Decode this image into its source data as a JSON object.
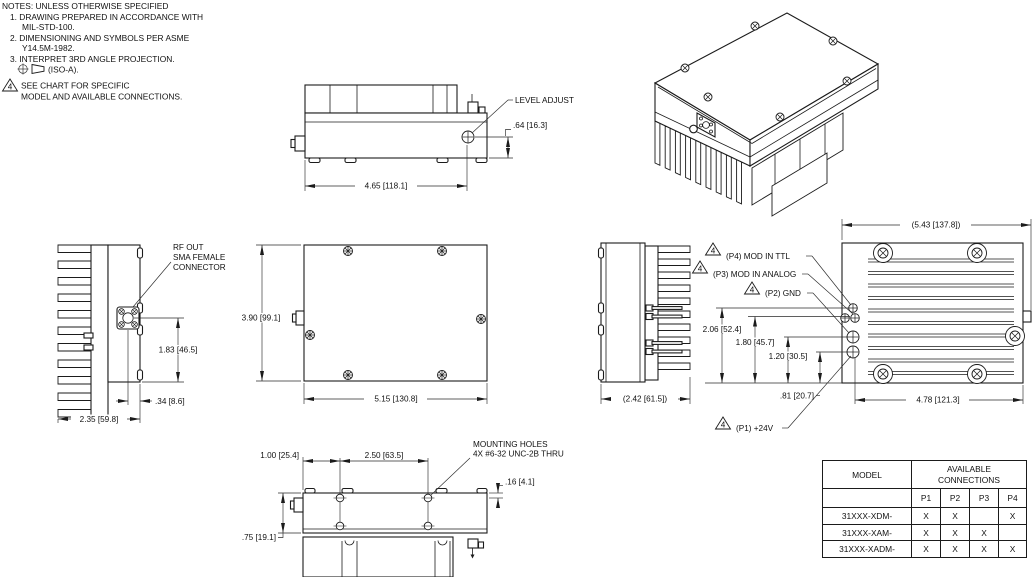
{
  "flag": "4",
  "notes": {
    "title": "NOTES:  UNLESS  OTHERWISE  SPECIFIED",
    "n1a": "1.  DRAWING  PREPARED  IN  ACCORDANCE  WITH",
    "n1b": "MIL-STD-100.",
    "n2a": "2.  DIMENSIONING  AND  SYMBOLS  PER  ASME",
    "n2b": "Y14.5M-1982.",
    "n3a": "3.  INTERPRET  3RD  ANGLE  PROJECTION.",
    "iso_label": "(ISO-A).",
    "n4a": "SEE  CHART  FOR  SPECIFIC",
    "n4b": "MODEL  AND  AVAILABLE  CONNECTIONS."
  },
  "callouts": {
    "level_adjust": "LEVEL  ADJUST",
    "rf_out_l1": "RF  OUT",
    "rf_out_l2": "SMA  FEMALE",
    "rf_out_l3": "CONNECTOR",
    "mounting_l1": "MOUNTING  HOLES",
    "mounting_l2": "4X  #6-32  UNC-2B  THRU",
    "p4": "(P4)  MOD  IN  TTL",
    "p3": "(P3)  MOD  IN  ANALOG",
    "p2": "(P2)  GND",
    "p1": "(P1)  +24V"
  },
  "dims": {
    "top_width": "4.65  [118.1]",
    "top_level_offset": ".64  [16.3]",
    "front_height": "3.90  [99.1]",
    "front_width": "5.15  [130.8]",
    "left_conn_height": "1.83  [46.5]",
    "left_conn_offset": ".34  [8.6]",
    "left_depth": "2.35  [59.8]",
    "right_depth": "(2.42  [61.5])",
    "rear_overall": "(5.43  [137.8])",
    "rear_hole_span": "4.78  [121.3]",
    "pin_p4": "2.06  [52.4]",
    "pin_p3": "1.80  [45.7]",
    "pin_p2": "1.20  [30.5]",
    "pin_p1": ".81  [20.7]",
    "bot_edge": "1.00  [25.4]",
    "bot_span": "2.50  [63.5]",
    "bot_hole_offset": ".16  [4.1]",
    "bot_height": ".75  [19.1]"
  },
  "table": {
    "model_header": "MODEL",
    "avail": "AVAILABLE\nCONNECTIONS",
    "cols": [
      "P1",
      "P2",
      "P3",
      "P4"
    ],
    "rows": [
      {
        "model": "31XXX-XDM-",
        "c": [
          "X",
          "X",
          "",
          "X"
        ]
      },
      {
        "model": "31XXX-XAM-",
        "c": [
          "X",
          "X",
          "X",
          ""
        ]
      },
      {
        "model": "31XXX-XADM-",
        "c": [
          "X",
          "X",
          "X",
          "X"
        ]
      }
    ]
  }
}
